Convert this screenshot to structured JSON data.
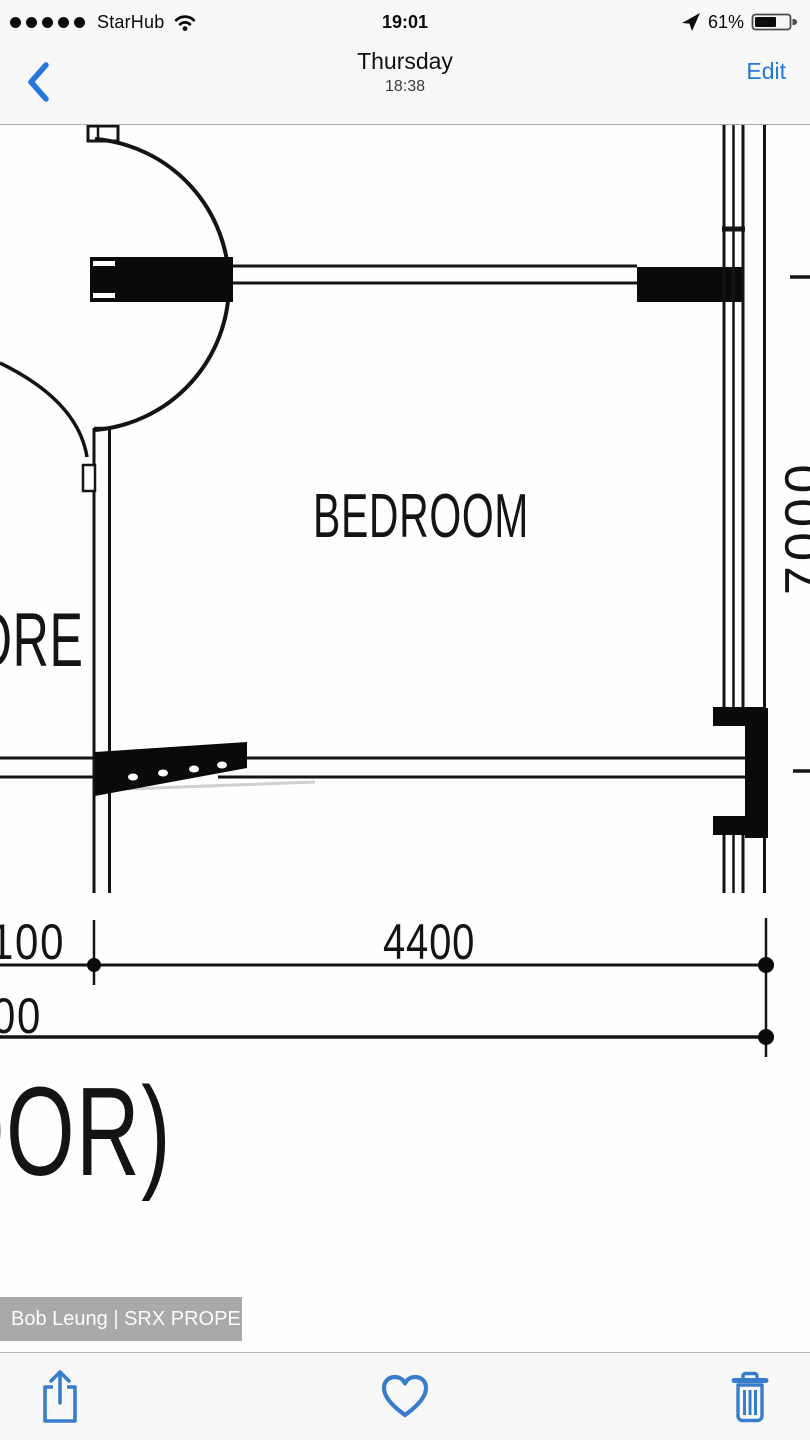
{
  "status_bar": {
    "carrier": "StarHub",
    "signal_strength": 5,
    "time": "19:01",
    "battery_percent": "61%",
    "battery_level": 61
  },
  "nav_bar": {
    "title": "Thursday",
    "subtitle": "18:38",
    "edit_label": "Edit"
  },
  "photo": {
    "floor_plan": {
      "room_label": "BEDROOM",
      "left_partial_label": "ORE",
      "rotated_dimension": "7000",
      "dim_top_left": "100",
      "dim_top_center": "4400",
      "dim_bottom_left": "00",
      "caption_partial": "OOR)"
    },
    "watermark": "Bob Leung | SRX PROPERTY"
  },
  "toolbar": {
    "icons": [
      "share",
      "heart",
      "trash"
    ]
  },
  "colors": {
    "accent_blue": "#2577dd",
    "toolbar_blue": "#377dcc",
    "header_bg": "#f8f8f8",
    "watermark_bg": "#a9a9a9",
    "plan_ink": "#141414"
  }
}
